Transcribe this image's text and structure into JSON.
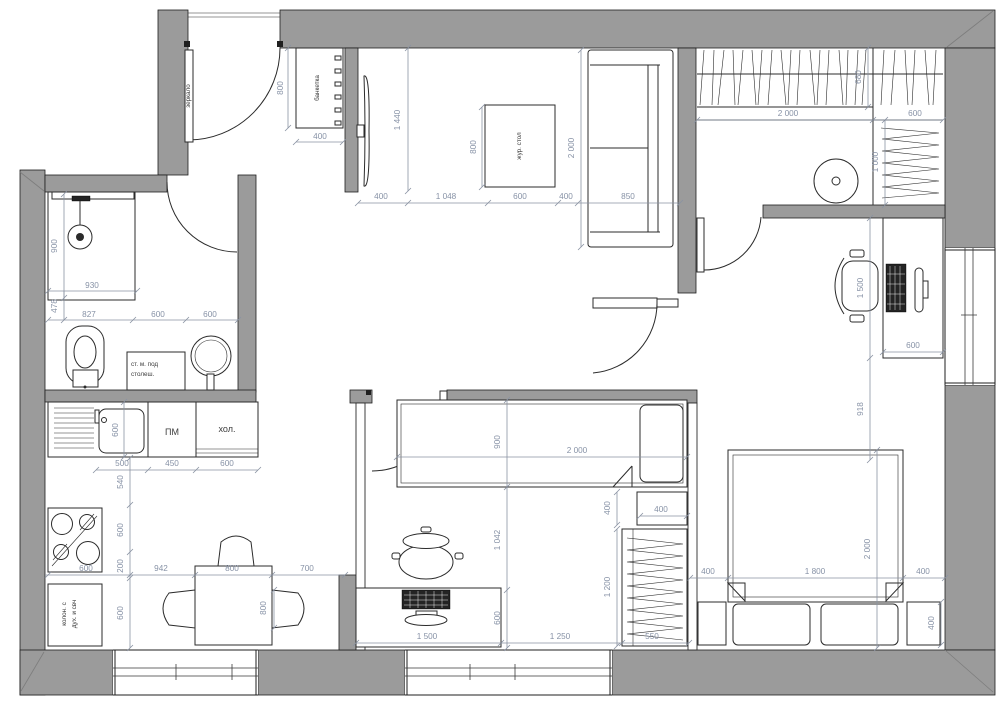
{
  "colors": {
    "wall_fill": "#9b9b9b",
    "outline": "#1f1f1f",
    "dim_text": "#8792a6",
    "furniture_line": "#2b2b2b",
    "background": "#ffffff"
  },
  "entry": {
    "mirror": "зеркало",
    "bench": "банкетка",
    "dim_bench_length": "800",
    "dim_bench_width": "400"
  },
  "bathroom": {
    "wm_line1": "ст. м. под",
    "wm_line2": "столеш.",
    "dim_shower": "900",
    "dim_930": "930",
    "dim_478": "478",
    "dim_827": "827",
    "dim_600a": "600",
    "dim_600b": "600"
  },
  "living": {
    "coffee_table": "жур. стол",
    "dim_tv": "1 440",
    "dim_400a": "400",
    "dim_1048": "1 048",
    "dim_600": "600",
    "dim_400b": "400",
    "dim_850": "850",
    "dim_sofa": "2 000",
    "dim_table": "800"
  },
  "wardrobe": {
    "dim_2000": "2 000",
    "dim_680": "680",
    "dim_600": "600",
    "dim_1000": "1 000"
  },
  "master": {
    "dim_desk": "1 500",
    "dim_desk_depth": "600",
    "dim_918": "918",
    "dim_400l": "400",
    "dim_1800": "1 800",
    "dim_400r": "400",
    "dim_2000": "2 000",
    "dim_nightstand": "400"
  },
  "child": {
    "dim_bed_w": "900",
    "dim_bed_l": "2 000",
    "dim_cab_v": "400",
    "dim_cab_h": "400",
    "dim_1200": "1 200",
    "dim_1042": "1 042",
    "dim_600": "600",
    "dim_desk": "1 500",
    "dim_1250": "1 250",
    "dim_550": "550"
  },
  "kitchen": {
    "dishwasher": "ПМ",
    "fridge": "хол.",
    "column_line1": "колон. с",
    "column_line2": "дух. и свч",
    "dim_sink_depth": "600",
    "dim_500": "500",
    "dim_450": "450",
    "dim_600top": "600",
    "dim_540": "540",
    "dim_600v1": "600",
    "dim_200": "200",
    "dim_600v2": "600",
    "dim_600stove": "600",
    "dim_942": "942",
    "dim_800": "800",
    "dim_700": "700",
    "dim_table": "800"
  }
}
